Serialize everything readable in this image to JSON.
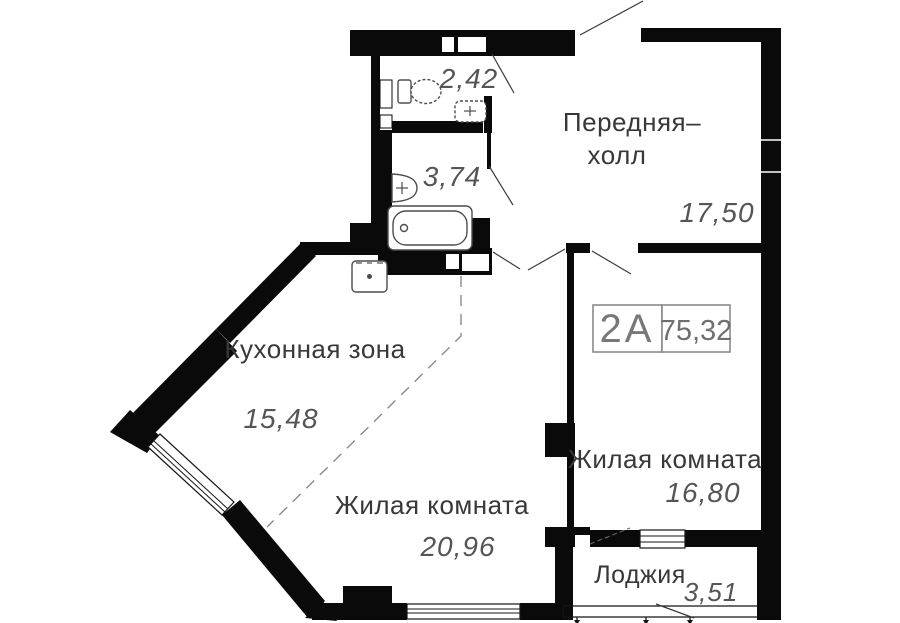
{
  "unit": {
    "type": "2А",
    "total_area": "75,32"
  },
  "rooms": [
    {
      "id": "hall",
      "name_line1": "Передняя–",
      "name_line2": "холл",
      "area": "17,50"
    },
    {
      "id": "wc",
      "area": "2,42"
    },
    {
      "id": "bathroom",
      "area": "3,74"
    },
    {
      "id": "kitchen",
      "name": "Кухонная зона",
      "area": "15,48"
    },
    {
      "id": "living-room-1",
      "name": "Жилая комната",
      "area": "20,96"
    },
    {
      "id": "living-room-2",
      "name": "Жилая комната",
      "area": "16,80"
    },
    {
      "id": "loggia",
      "name": "Лоджия",
      "area": "3,51"
    }
  ],
  "colors": {
    "wall": "#0a0a0a",
    "room_name_text": "#383838",
    "area_text": "#555555",
    "badge_border": "#8a8a8a",
    "background": "#ffffff"
  }
}
